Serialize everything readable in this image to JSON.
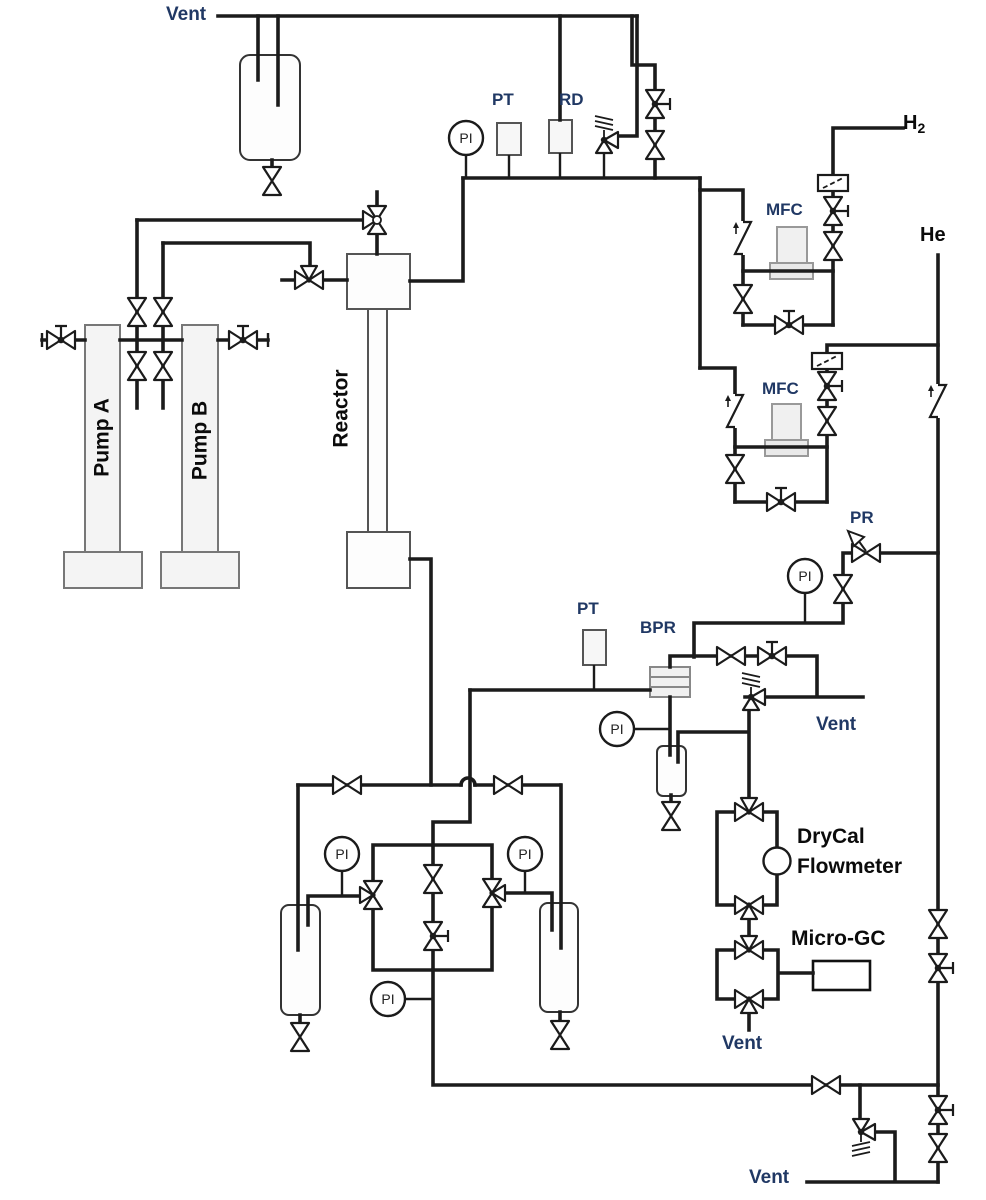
{
  "diagram": {
    "type": "piping-and-instrumentation-diagram",
    "labels": {
      "vent": "Vent",
      "h2_base": "H",
      "h2_sub": "2",
      "he": "He",
      "mfc": "MFC",
      "pt": "PT",
      "rd": "RD",
      "pi": "PI",
      "pr": "PR",
      "bpr": "BPR",
      "pump_a": "Pump A",
      "pump_b": "Pump B",
      "reactor": "Reactor",
      "drycal_line1": "DryCal",
      "drycal_line2": "Flowmeter",
      "micro_gc": "Micro-GC"
    },
    "colors": {
      "line": "#1b1b1b",
      "tag_label": "#203864",
      "text_label": "#111111",
      "equipment_fill": "#f2f2f2",
      "background": "#ffffff"
    }
  }
}
